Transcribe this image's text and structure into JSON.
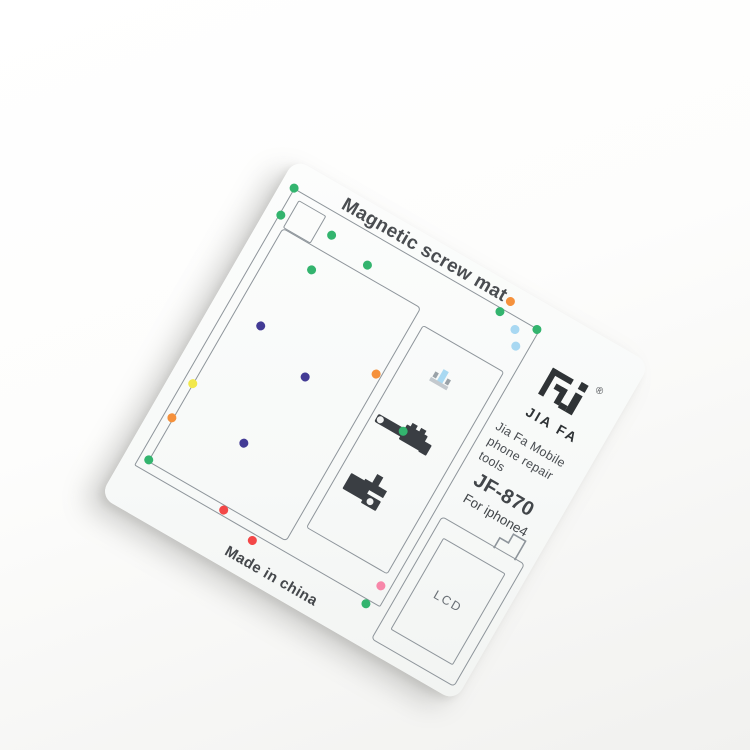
{
  "product": {
    "title": "Magnetic screw mat",
    "brand": "JIA FA",
    "registered_mark": "®",
    "tagline": [
      "Jia Fa  Mobile",
      "phone  repair",
      "tools"
    ],
    "model": "JF-870",
    "compatibility": "For iphone4",
    "lcd_label": "LCD",
    "origin": "Made in china"
  },
  "colors": {
    "card_bg": "#f9fbfa",
    "outline_gray": "#8e959b",
    "ink": "#42464a",
    "logo_ink": "#2f3336"
  },
  "dot_colors": {
    "green": "#33b46e",
    "orange": "#f5913c",
    "cyan": "#a8d8f2",
    "purple": "#433b95",
    "yellow": "#f2e84a",
    "red": "#f34747",
    "pink": "#f787a9"
  },
  "dots": [
    {
      "color": "green",
      "x": 14,
      "y": 26
    },
    {
      "color": "green",
      "x": 16,
      "y": 56
    },
    {
      "color": "green",
      "x": 70,
      "y": 48
    },
    {
      "color": "green",
      "x": 116,
      "y": 56
    },
    {
      "color": "green",
      "x": 70,
      "y": 88
    },
    {
      "color": "orange",
      "x": 258,
      "y": 16
    },
    {
      "color": "green",
      "x": 254,
      "y": 30
    },
    {
      "color": "cyan",
      "x": 276,
      "y": 38
    },
    {
      "color": "green",
      "x": 295,
      "y": 27
    },
    {
      "color": "cyan",
      "x": 285,
      "y": 52
    },
    {
      "color": "orange",
      "x": 178,
      "y": 146
    },
    {
      "color": "purple",
      "x": 54,
      "y": 162
    },
    {
      "color": "purple",
      "x": 118,
      "y": 184
    },
    {
      "color": "green",
      "x": 230,
      "y": 182
    },
    {
      "color": "yellow",
      "x": 24,
      "y": 246
    },
    {
      "color": "orange",
      "x": 23,
      "y": 286
    },
    {
      "color": "green",
      "x": 24,
      "y": 334
    },
    {
      "color": "purple",
      "x": 98,
      "y": 272
    },
    {
      "color": "red",
      "x": 114,
      "y": 340
    },
    {
      "color": "red",
      "x": 154,
      "y": 352
    },
    {
      "color": "pink",
      "x": 288,
      "y": 327
    },
    {
      "color": "green",
      "x": 284,
      "y": 350
    }
  ]
}
